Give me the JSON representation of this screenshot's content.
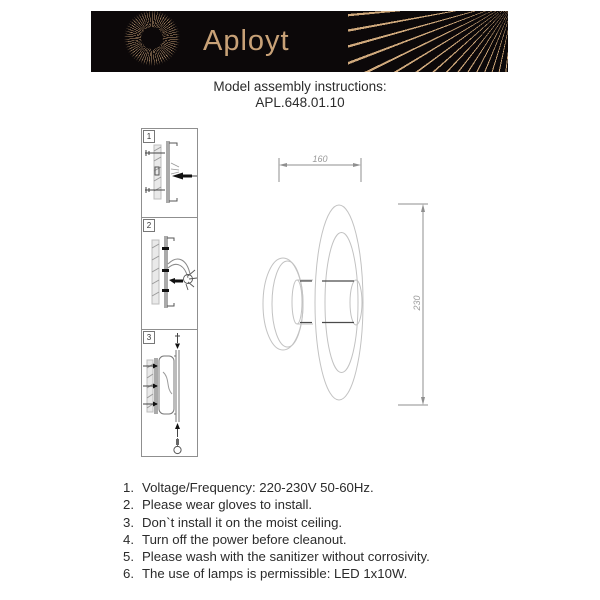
{
  "header": {
    "brand": "Aployt",
    "colors": {
      "banner_bg": "#0c0809",
      "brand_gold": "#c8a177"
    }
  },
  "title": {
    "line1": "Model assembly instructions:",
    "model": "APL.648.01.10"
  },
  "steps": [
    {
      "num": "1"
    },
    {
      "num": "2"
    },
    {
      "num": "3"
    }
  ],
  "drawing": {
    "width_label": "160",
    "height_label": "230"
  },
  "instructions": {
    "items": [
      {
        "num": "1.",
        "text": "Voltage/Frequency: 220-230V 50-60Hz."
      },
      {
        "num": "2.",
        "text": "Please wear gloves to install."
      },
      {
        "num": "3.",
        "text": "Don`t install it on the moist ceiling."
      },
      {
        "num": "4.",
        "text": "Turn off the power before cleanout."
      },
      {
        "num": "5.",
        "text": "Please wash with the sanitizer without corrosivity."
      },
      {
        "num": "6.",
        "text": "The use of lamps is permissible: LED 1x10W."
      }
    ]
  }
}
